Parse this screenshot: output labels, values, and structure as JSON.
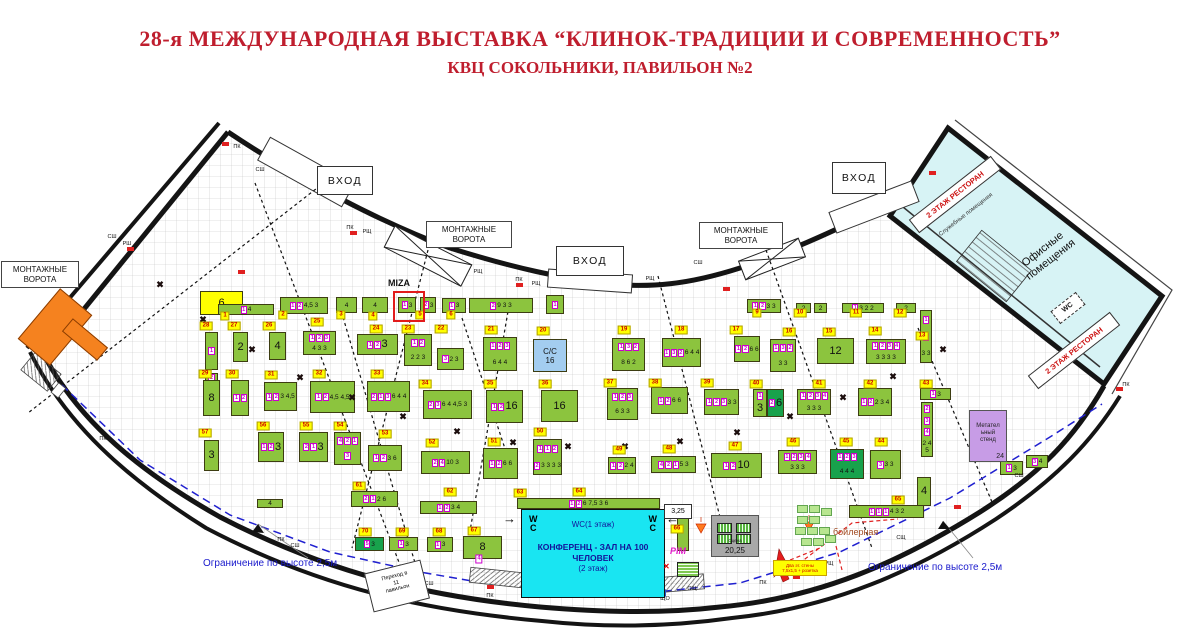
{
  "title": {
    "line1": "28-я МЕЖДУНАРОДНАЯ ВЫСТАВКА  “КЛИНОК-ТРАДИЦИИ И СОВРЕМЕННОСТЬ”",
    "line2": "КВЦ СОКОЛЬНИКИ, ПАВИЛЬОН №2"
  },
  "colors": {
    "title_red": "#bf1e2e",
    "booth_green": "#8cc43e",
    "booth_dark_green": "#18a24c",
    "tag_yellow": "#ffff00",
    "tag_text_red": "#cc0000",
    "magenta": "#cc00cc",
    "conference_cyan": "#19e5f2",
    "wing_cyan": "#d7f3f5",
    "purple": "#c79ce6",
    "orange": "#f5821f",
    "blue_note": "#1a1acc",
    "cc_blue": "#a3cdf0",
    "stage_gray": "#a8a8a8",
    "boiler_brown": "#a14a20"
  },
  "entrances": [
    {
      "label": "ВХОД",
      "x": 317,
      "y": 166,
      "w": 54,
      "h": 27
    },
    {
      "label": "ВХОД",
      "x": 556,
      "y": 246,
      "w": 66,
      "h": 28
    },
    {
      "label": "ВХОД",
      "x": 832,
      "y": 162,
      "w": 52,
      "h": 30
    }
  ],
  "gates": [
    {
      "label": "МОНТАЖНЫЕ\nВОРОТА",
      "x": 1,
      "y": 261,
      "w": 72
    },
    {
      "label": "МОНТАЖНЫЕ\nВОРОТА",
      "x": 426,
      "y": 221,
      "w": 80
    },
    {
      "label": "МОНТАЖНЫЕ\nВОРОТА",
      "x": 699,
      "y": 222,
      "w": 78
    }
  ],
  "plan": {
    "miza": "MIZA",
    "booths": [
      [
        200,
        291,
        43,
        24,
        "y",
        "",
        "6"
      ],
      [
        218,
        304,
        56,
        11,
        "g",
        "1",
        "4"
      ],
      [
        280,
        297,
        48,
        17,
        "g",
        "1 2",
        "4,5 3"
      ],
      [
        336,
        297,
        21,
        16,
        "g",
        "",
        "4"
      ],
      [
        362,
        297,
        26,
        16,
        "g",
        "",
        "4"
      ],
      [
        398,
        297,
        18,
        16,
        "g",
        "1",
        "3"
      ],
      [
        420,
        297,
        16,
        16,
        "g",
        "2",
        "3"
      ],
      [
        442,
        298,
        24,
        15,
        "g",
        "1",
        "3"
      ],
      [
        469,
        298,
        64,
        15,
        "g",
        "2",
        "9 3 3"
      ],
      [
        546,
        295,
        18,
        19,
        "g",
        "1",
        ""
      ],
      [
        747,
        299,
        34,
        14,
        "g",
        "1 2",
        "3 3"
      ],
      [
        796,
        303,
        15,
        10,
        "g",
        "",
        "2"
      ],
      [
        814,
        303,
        13,
        10,
        "g",
        "",
        "2"
      ],
      [
        842,
        303,
        42,
        10,
        "g",
        "1",
        "3 2 2"
      ],
      [
        896,
        303,
        20,
        10,
        "g",
        "",
        "2"
      ],
      [
        205,
        332,
        13,
        38,
        "g",
        "1",
        ""
      ],
      [
        205,
        373,
        13,
        22,
        "g",
        "2",
        "2"
      ],
      [
        233,
        332,
        15,
        30,
        "g",
        "",
        "2"
      ],
      [
        269,
        332,
        17,
        28,
        "g",
        "",
        "4"
      ],
      [
        303,
        331,
        33,
        24,
        "g",
        "1 2 3",
        "4 3 3"
      ],
      [
        357,
        334,
        41,
        21,
        "g",
        "1 2",
        "3"
      ],
      [
        404,
        334,
        28,
        32,
        "g",
        "1 2",
        "2 2 3"
      ],
      [
        437,
        348,
        27,
        22,
        "g",
        "3",
        "2 3"
      ],
      [
        483,
        337,
        34,
        34,
        "g",
        "1 2 3",
        "6 4 4"
      ],
      [
        533,
        339,
        34,
        33,
        "b",
        "",
        "С/С\n16"
      ],
      [
        612,
        338,
        33,
        33,
        "g",
        "1 3 2",
        "8 6 2"
      ],
      [
        662,
        338,
        39,
        29,
        "g",
        "1 3 2",
        "6 4 4"
      ],
      [
        734,
        336,
        26,
        26,
        "g",
        "1 2",
        "6 6"
      ],
      [
        770,
        339,
        26,
        33,
        "g",
        "1 3 2",
        "3 3"
      ],
      [
        817,
        338,
        37,
        26,
        "g",
        "",
        "12"
      ],
      [
        866,
        339,
        40,
        25,
        "g",
        "1 2 3 4",
        "3 3 3 3"
      ],
      [
        920,
        310,
        12,
        53,
        "g",
        "1 2",
        "3 3"
      ],
      [
        203,
        380,
        17,
        36,
        "g",
        "",
        "8"
      ],
      [
        231,
        380,
        18,
        36,
        "g",
        "1 2",
        ""
      ],
      [
        264,
        382,
        33,
        29,
        "g",
        "1 2",
        "3 4,5"
      ],
      [
        310,
        381,
        45,
        32,
        "g",
        "1 2",
        "4,5 4,5"
      ],
      [
        367,
        381,
        43,
        31,
        "g",
        "2 1 3",
        "6 4 4"
      ],
      [
        423,
        390,
        49,
        29,
        "g",
        "2 3",
        "6 4 4,5 3"
      ],
      [
        486,
        390,
        37,
        33,
        "g",
        "1 2",
        "16"
      ],
      [
        541,
        390,
        37,
        32,
        "g",
        "",
        "16"
      ],
      [
        607,
        388,
        31,
        32,
        "g",
        "1 2 3",
        "6 3 3"
      ],
      [
        651,
        387,
        37,
        27,
        "g",
        "1 2",
        "6 6"
      ],
      [
        704,
        389,
        35,
        26,
        "g",
        "1 2 3",
        "3 3"
      ],
      [
        753,
        389,
        14,
        28,
        "g",
        "1",
        "3"
      ],
      [
        767,
        389,
        17,
        28,
        "dg",
        "2",
        "6"
      ],
      [
        797,
        389,
        34,
        26,
        "g",
        "1 2 3 4",
        "3 3 3"
      ],
      [
        858,
        388,
        34,
        28,
        "g",
        "1 2",
        "2 3 4"
      ],
      [
        920,
        388,
        31,
        12,
        "g",
        "1",
        "3"
      ],
      [
        921,
        402,
        12,
        55,
        "g",
        "2 3 4",
        "2 4 5"
      ],
      [
        204,
        440,
        15,
        31,
        "g",
        "",
        "3"
      ],
      [
        258,
        432,
        26,
        30,
        "g",
        "1 2",
        "3"
      ],
      [
        299,
        432,
        29,
        30,
        "g",
        "2 1",
        "3"
      ],
      [
        334,
        432,
        27,
        33,
        "g",
        "4 2 1 3",
        ""
      ],
      [
        368,
        445,
        34,
        26,
        "g",
        "1 2",
        "3 6"
      ],
      [
        421,
        451,
        49,
        23,
        "g",
        "2 4",
        "10 3"
      ],
      [
        483,
        448,
        35,
        31,
        "g",
        "1 2",
        "6 6"
      ],
      [
        533,
        439,
        29,
        36,
        "g",
        "1 1 2 2",
        "3 3 3 3"
      ],
      [
        608,
        457,
        28,
        17,
        "g",
        "1 2",
        "2 4"
      ],
      [
        651,
        456,
        45,
        17,
        "g",
        "4 2 1",
        "5 3"
      ],
      [
        711,
        453,
        51,
        25,
        "g",
        "1 2",
        "10"
      ],
      [
        778,
        450,
        39,
        24,
        "g",
        "1 2 3 4",
        "3 3 3"
      ],
      [
        830,
        449,
        34,
        30,
        "dg",
        "1 2 3",
        "4 4 4"
      ],
      [
        870,
        450,
        31,
        29,
        "g",
        "3",
        "3 3"
      ],
      [
        257,
        499,
        26,
        9,
        "g",
        "",
        "4"
      ],
      [
        351,
        491,
        47,
        16,
        "g",
        "2 1",
        "2 6"
      ],
      [
        420,
        501,
        57,
        13,
        "g",
        "1 2",
        "3 4"
      ],
      [
        355,
        537,
        29,
        14,
        "dg",
        "5",
        "3"
      ],
      [
        389,
        537,
        29,
        14,
        "g",
        "1",
        "3"
      ],
      [
        427,
        537,
        26,
        15,
        "g",
        "1",
        "3"
      ],
      [
        463,
        536,
        39,
        23,
        "g",
        "",
        "8"
      ],
      [
        517,
        498,
        143,
        11,
        "g",
        "1 2",
        "6 7,5 3 6"
      ],
      [
        677,
        516,
        12,
        35,
        "g",
        "",
        ""
      ],
      [
        849,
        505,
        75,
        13,
        "g",
        "1 1 1",
        "4 3 2"
      ],
      [
        917,
        477,
        14,
        29,
        "g",
        "",
        "4"
      ],
      [
        1000,
        461,
        23,
        14,
        "g",
        "1",
        "3"
      ],
      [
        1026,
        455,
        22,
        13,
        "g",
        "3",
        "4"
      ]
    ],
    "tags": [
      [
        225,
        316,
        "1"
      ],
      [
        283,
        315,
        "2"
      ],
      [
        341,
        315,
        "3"
      ],
      [
        373,
        316,
        "4"
      ],
      [
        317,
        322,
        "25"
      ],
      [
        420,
        315,
        "5"
      ],
      [
        451,
        315,
        "6"
      ],
      [
        757,
        313,
        "9"
      ],
      [
        800,
        313,
        "10"
      ],
      [
        856,
        313,
        "11"
      ],
      [
        900,
        313,
        "12"
      ],
      [
        206,
        326,
        "28"
      ],
      [
        234,
        326,
        "27"
      ],
      [
        269,
        326,
        "26"
      ],
      [
        376,
        329,
        "24"
      ],
      [
        408,
        329,
        "23"
      ],
      [
        441,
        329,
        "22"
      ],
      [
        491,
        330,
        "21"
      ],
      [
        543,
        331,
        "20"
      ],
      [
        624,
        330,
        "19"
      ],
      [
        681,
        330,
        "18"
      ],
      [
        736,
        330,
        "17"
      ],
      [
        789,
        332,
        "16"
      ],
      [
        829,
        332,
        "15"
      ],
      [
        875,
        331,
        "14"
      ],
      [
        922,
        336,
        "13"
      ],
      [
        205,
        374,
        "29"
      ],
      [
        232,
        374,
        "30"
      ],
      [
        271,
        375,
        "31"
      ],
      [
        319,
        374,
        "32"
      ],
      [
        377,
        374,
        "33"
      ],
      [
        425,
        384,
        "34"
      ],
      [
        490,
        384,
        "35"
      ],
      [
        545,
        384,
        "36"
      ],
      [
        610,
        383,
        "37"
      ],
      [
        655,
        383,
        "38"
      ],
      [
        707,
        383,
        "39"
      ],
      [
        756,
        384,
        "40"
      ],
      [
        819,
        384,
        "41"
      ],
      [
        870,
        384,
        "42"
      ],
      [
        926,
        384,
        "43"
      ],
      [
        205,
        433,
        "57"
      ],
      [
        263,
        426,
        "56"
      ],
      [
        306,
        426,
        "55"
      ],
      [
        340,
        426,
        "54"
      ],
      [
        385,
        434,
        "53"
      ],
      [
        432,
        443,
        "52"
      ],
      [
        494,
        442,
        "51"
      ],
      [
        540,
        432,
        "50"
      ],
      [
        619,
        450,
        "49"
      ],
      [
        669,
        449,
        "48"
      ],
      [
        735,
        446,
        "47"
      ],
      [
        793,
        442,
        "46"
      ],
      [
        846,
        442,
        "45"
      ],
      [
        881,
        442,
        "44"
      ],
      [
        359,
        486,
        "61"
      ],
      [
        450,
        492,
        "62"
      ],
      [
        520,
        493,
        "63"
      ],
      [
        579,
        492,
        "64"
      ],
      [
        677,
        529,
        "66"
      ],
      [
        365,
        532,
        "70"
      ],
      [
        402,
        532,
        "69"
      ],
      [
        439,
        532,
        "68"
      ],
      [
        474,
        531,
        "67"
      ],
      [
        898,
        500,
        "65"
      ]
    ],
    "mtags": [
      [
        479,
        559,
        "4"
      ]
    ],
    "wall_labels": [
      [
        237,
        147,
        "ПК"
      ],
      [
        260,
        170,
        "СШ"
      ],
      [
        112,
        237,
        "СШ"
      ],
      [
        127,
        244,
        "РШ"
      ],
      [
        350,
        228,
        "ПК"
      ],
      [
        367,
        232,
        "РЩ"
      ],
      [
        478,
        272,
        "РЩ"
      ],
      [
        519,
        280,
        "ПК"
      ],
      [
        536,
        284,
        "РЩ"
      ],
      [
        650,
        279,
        "РЩ"
      ],
      [
        698,
        263,
        "СШ"
      ],
      [
        736,
        235,
        "ПК"
      ],
      [
        756,
        239,
        "РЩ"
      ],
      [
        1126,
        385,
        "ПК"
      ],
      [
        281,
        540,
        "ПК"
      ],
      [
        295,
        546,
        "СШ"
      ],
      [
        429,
        584,
        "СШ"
      ],
      [
        490,
        596,
        "ПК"
      ],
      [
        647,
        588,
        "РЩ"
      ],
      [
        665,
        599,
        "ЩО"
      ],
      [
        692,
        589,
        "СЩ"
      ],
      [
        763,
        583,
        "ПК"
      ],
      [
        829,
        564,
        "РЩ"
      ],
      [
        901,
        538,
        "СЩ"
      ],
      [
        1019,
        476,
        "СШ"
      ],
      [
        103,
        439,
        "ПК"
      ]
    ],
    "xmarks": [
      [
        160,
        285
      ],
      [
        203,
        320
      ],
      [
        252,
        350
      ],
      [
        300,
        378
      ],
      [
        352,
        398
      ],
      [
        403,
        417
      ],
      [
        457,
        432
      ],
      [
        513,
        443
      ],
      [
        568,
        447
      ],
      [
        625,
        447
      ],
      [
        680,
        442
      ],
      [
        737,
        433
      ],
      [
        790,
        417
      ],
      [
        843,
        398
      ],
      [
        893,
        377
      ],
      [
        943,
        350
      ]
    ],
    "red_marks": [
      [
        222,
        142
      ],
      [
        350,
        231
      ],
      [
        516,
        283
      ],
      [
        723,
        287
      ],
      [
        929,
        171
      ],
      [
        1116,
        387
      ],
      [
        487,
        585
      ],
      [
        954,
        505
      ],
      [
        793,
        575
      ],
      [
        127,
        247
      ],
      [
        238,
        270
      ]
    ],
    "furniture": [
      [
        797,
        505
      ],
      [
        809,
        505
      ],
      [
        821,
        508
      ],
      [
        797,
        516
      ],
      [
        809,
        516
      ],
      [
        795,
        527
      ],
      [
        807,
        527
      ],
      [
        819,
        527
      ],
      [
        801,
        538
      ],
      [
        813,
        538
      ],
      [
        825,
        535
      ]
    ],
    "throwing_stand": {
      "text": "Метател\nьный\nстенд",
      "num": "24"
    },
    "stage": {
      "name": "Сцена",
      "num": "20,25"
    },
    "conference": {
      "wc_line": "WC(1 этаж)",
      "line1": "КОНФЕРЕНЦ - ЗАЛ НА 100",
      "line2": "ЧЕЛОВЕК",
      "line3": "(2 этаж)",
      "wc_left": "W\nC",
      "wc_right": "W\nC",
      "arrow_left": "→",
      "arrow_right": "←"
    },
    "wing": {
      "office": "Офисные\nпомещения",
      "restaurant1": "2 ЭТАЖ РЕСТОРАН",
      "restaurant2": "2 ЭТАЖ РЕСТОРАН",
      "service": "Служебные помещения",
      "wc": "WC"
    },
    "notes": {
      "limit_left": "Ограничение по высоте 2,5м",
      "limit_right": "Ограничение по высоте 2,5м",
      "perehod": "Переход в\n11\nпавильон",
      "boiler": "бойлерная",
      "pim": "PIM",
      "h325": "3,25",
      "wall_note": "Два эт. стены\n7,5х1,5 + розетка"
    }
  }
}
